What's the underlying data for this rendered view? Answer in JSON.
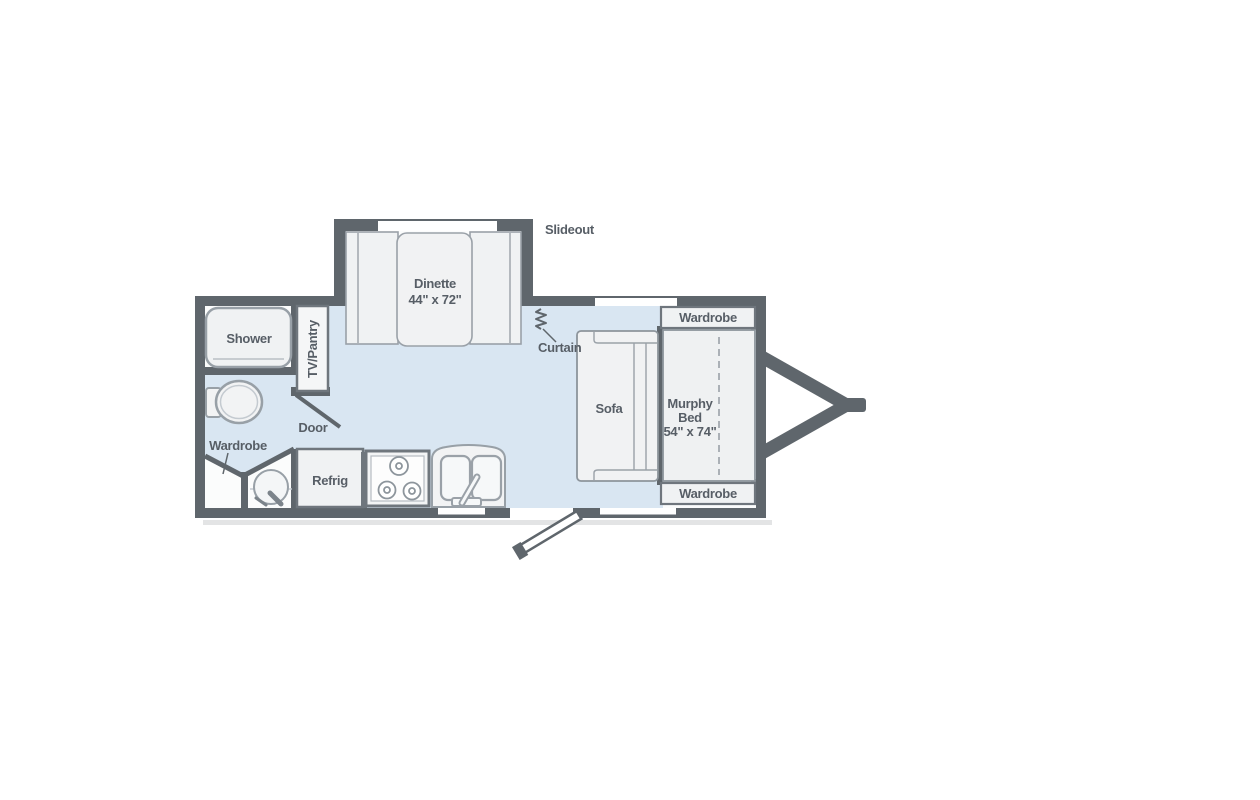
{
  "plan": {
    "type": "travel-trailer-floor-plan",
    "labels": {
      "slideout": "Slideout",
      "dinette_name": "Dinette",
      "dinette_size": "44\" x 72\"",
      "curtain": "Curtain",
      "wardrobe_top": "Wardrobe",
      "wardrobe_bottom": "Wardrobe",
      "wardrobe_bath": "Wardrobe",
      "sofa": "Sofa",
      "murphy_line1": "Murphy",
      "murphy_line2": "Bed",
      "murphy_size": "54\" x 74\"",
      "shower": "Shower",
      "tv_pantry": "TV/Pantry",
      "door": "Door",
      "refrig": "Refrig"
    },
    "colors": {
      "wall": "#5f666c",
      "floor_blue": "#d9e6f2",
      "floor_white": "#fbfcfc",
      "fixture_fill": "#f0f2f3",
      "fixture_border": "#98a0a7",
      "cabinet_border": "#6f767d",
      "label_text": "#575e66",
      "window": "#ffffff",
      "shadow": "#e3e4e5"
    }
  }
}
